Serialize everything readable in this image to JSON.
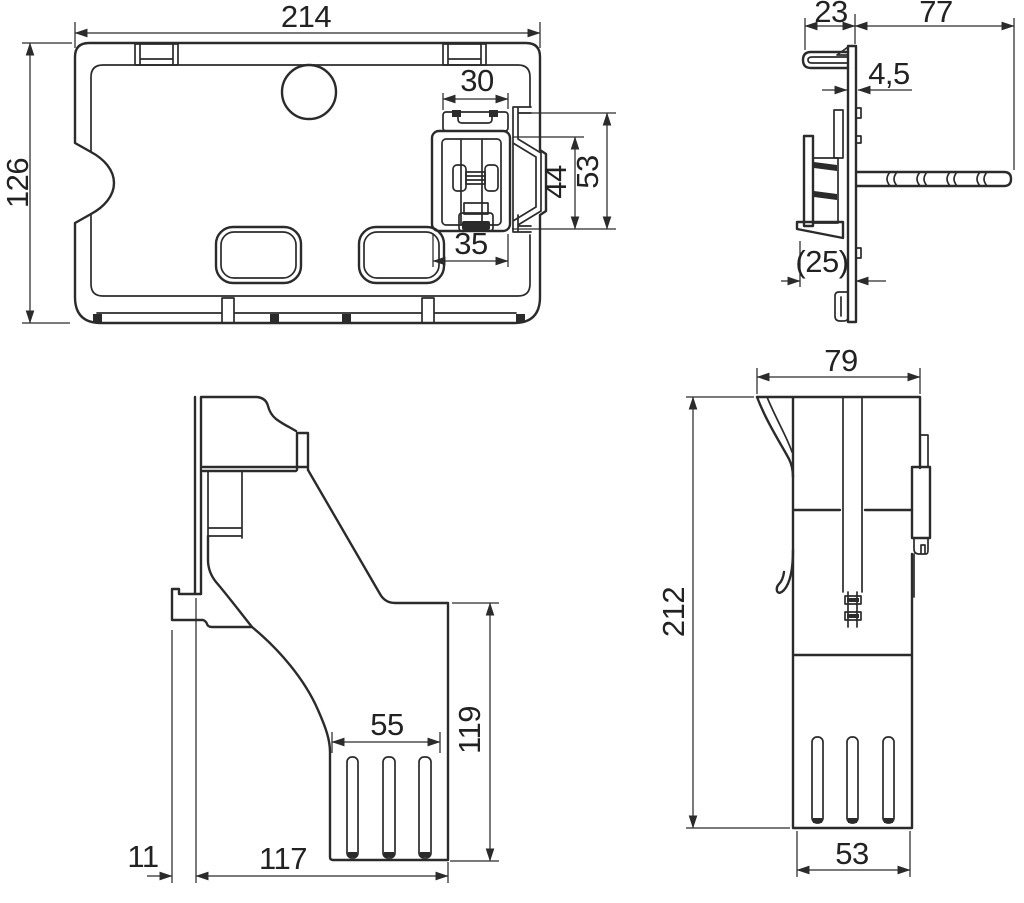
{
  "colors": {
    "line": "#2b2b2b",
    "background": "#ffffff"
  },
  "views": {
    "front": {
      "width": "214",
      "height": "126",
      "clip_width": "30",
      "valve_inner_height": "44",
      "valve_height": "53",
      "valve_width": "35"
    },
    "side": {
      "hook_depth": "23",
      "rod_length": "77",
      "plate_thickness": "4,5",
      "bracket_depth": "(25)"
    },
    "profile": {
      "slot_width": "55",
      "lower_height": "119",
      "foot_offset": "11",
      "base_length": "117"
    },
    "rear": {
      "width": "79",
      "height": "212",
      "base_width": "53"
    }
  }
}
